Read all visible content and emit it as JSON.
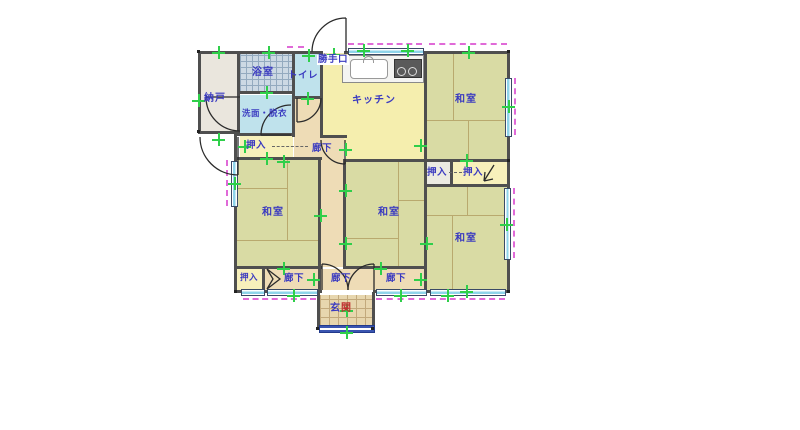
{
  "plan": {
    "labels": {
      "nando": "納戸",
      "yokushitsu": "浴室",
      "toire": "トイレ",
      "senmen": "洗面・脱衣",
      "katteguchi": "勝手口",
      "kitchen": "キッチン",
      "washitsu": "和室",
      "oshiire": "押入",
      "rouka": "廊下",
      "genkan_a": "玄",
      "genkan_b": "関"
    },
    "colors": {
      "tatami": "#d9dba4",
      "kitchen": "#f5eeae",
      "corridor": "#eedcb6",
      "closet": "#f7f0bb",
      "water_blue": "#bfe2ec",
      "bath_grid": "#ccd9e4",
      "storage": "#eae6dd",
      "entrance_tile": "#e7d6ae",
      "wall": "#4f4f4f",
      "label_text": "#3a3ac0",
      "entrance_accent": "#c03030",
      "grid_mark_green": "#2fcf4a",
      "insulation_dash_magenta": "#e06ad8",
      "window_cyan": "#8fd4ea"
    }
  }
}
